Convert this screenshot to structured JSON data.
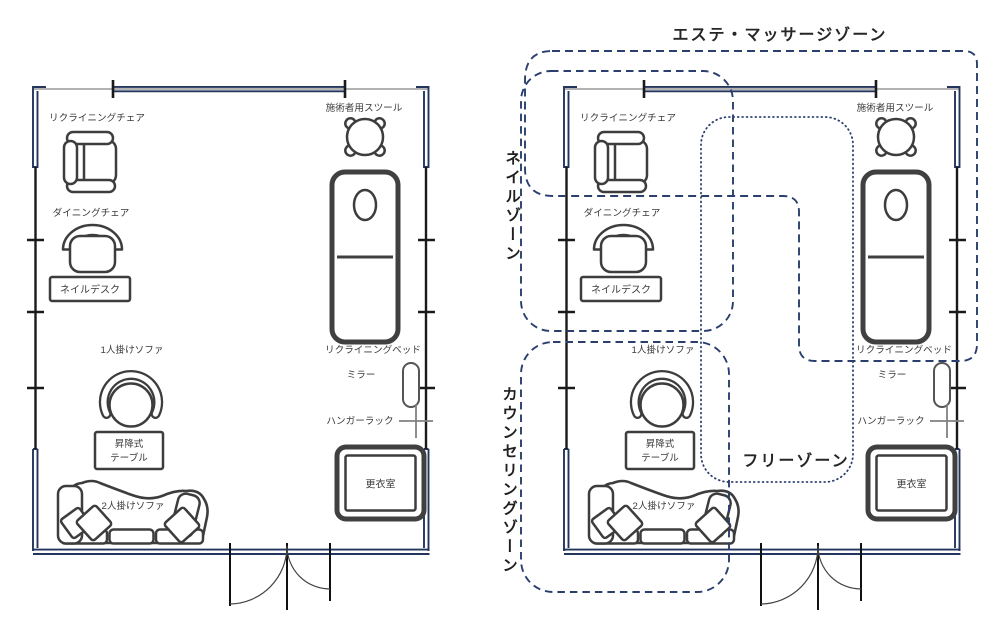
{
  "zones": {
    "este_massage": {
      "label": "エステ・マッサージゾーン"
    },
    "nail": {
      "label": "ネイルゾーン"
    },
    "counseling": {
      "label": "カウンセリングゾーン"
    },
    "free": {
      "label": "フリーゾーン"
    }
  },
  "furniture": {
    "recliner_chair": "リクライニングチェア",
    "therapist_stool": "施術者用スツール",
    "dining_chair": "ダイニングチェア",
    "nail_desk": "ネイルデスク",
    "single_sofa": "1人掛けソファ",
    "lift_table_line1": "昇降式",
    "lift_table_line2": "テーブル",
    "double_sofa": "2人掛けソファ",
    "recliner_bed": "リクライニングベッド",
    "mirror": "ミラー",
    "hanger_rack": "ハンガーラック",
    "changing_room": "更衣室"
  },
  "colors": {
    "wall": "#23355c",
    "zone_line": "#2b3f6e",
    "furniture_line": "#3d3d3d"
  }
}
